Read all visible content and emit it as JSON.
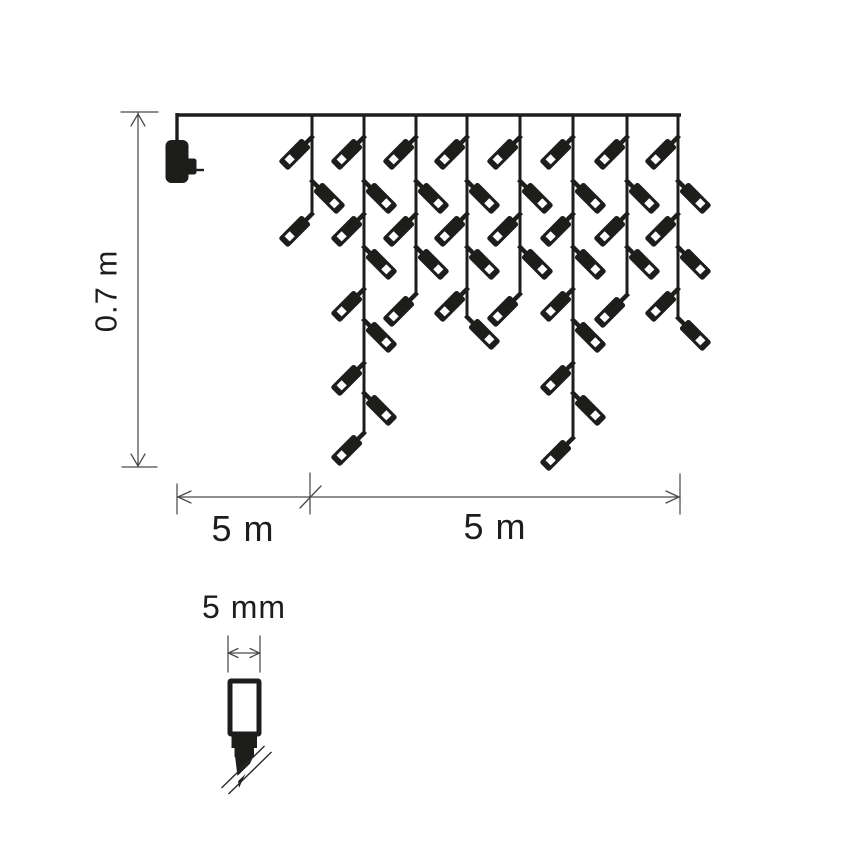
{
  "diagram": {
    "description": "Dimension diagram of icicle christmas light chain with power adapter and LED bulb detail",
    "colors": {
      "ink": "#1d1d1b",
      "dim_line": "#4a4a4a",
      "background": "#ffffff",
      "bulb_window": "#ffffff"
    },
    "labels": {
      "height": "0.7 m",
      "lead_length": "5 m",
      "lit_length": "5 m",
      "bulb_width": "5 mm"
    },
    "label_positions": {
      "height": {
        "x": 106,
        "y": 291
      },
      "lead_length": {
        "x": 243,
        "y": 529
      },
      "lit_length": {
        "x": 495,
        "y": 527
      },
      "bulb_width": {
        "x": 244,
        "y": 607
      }
    },
    "main_wire": {
      "x1": 177,
      "x2": 681,
      "y": 115,
      "thickness": 3.4
    },
    "adapter": {
      "drop": {
        "x": 177,
        "y1": 113,
        "y2": 143
      },
      "body": {
        "x": 165.5,
        "y": 140,
        "w": 23,
        "h": 43,
        "rx": 6
      },
      "tab": {
        "x": 186,
        "y": 158.5,
        "w": 10.5,
        "h": 16,
        "rx": 2.5
      },
      "prong": {
        "x1": 196,
        "y1": 170,
        "x2": 204,
        "y2": 170
      }
    },
    "strands": [
      {
        "x": 312,
        "end": 214,
        "bulbs": [
          {
            "y": 137,
            "dir": "left"
          },
          {
            "y": 181,
            "dir": "right"
          },
          {
            "y": 214,
            "dir": "left"
          }
        ]
      },
      {
        "x": 364,
        "end": 433,
        "bulbs": [
          {
            "y": 137,
            "dir": "left"
          },
          {
            "y": 181,
            "dir": "right"
          },
          {
            "y": 214,
            "dir": "left"
          },
          {
            "y": 247,
            "dir": "right"
          },
          {
            "y": 289,
            "dir": "left"
          },
          {
            "y": 320,
            "dir": "right"
          },
          {
            "y": 363,
            "dir": "left"
          },
          {
            "y": 393,
            "dir": "right"
          },
          {
            "y": 433,
            "dir": "left"
          }
        ]
      },
      {
        "x": 416,
        "end": 294,
        "bulbs": [
          {
            "y": 137,
            "dir": "left"
          },
          {
            "y": 181,
            "dir": "right"
          },
          {
            "y": 214,
            "dir": "left"
          },
          {
            "y": 247,
            "dir": "right"
          },
          {
            "y": 294,
            "dir": "left"
          }
        ]
      },
      {
        "x": 467,
        "end": 317,
        "bulbs": [
          {
            "y": 137,
            "dir": "left"
          },
          {
            "y": 181,
            "dir": "right"
          },
          {
            "y": 214,
            "dir": "left"
          },
          {
            "y": 247,
            "dir": "right"
          },
          {
            "y": 289,
            "dir": "left"
          },
          {
            "y": 317,
            "dir": "right"
          }
        ]
      },
      {
        "x": 520,
        "end": 294,
        "bulbs": [
          {
            "y": 137,
            "dir": "left"
          },
          {
            "y": 181,
            "dir": "right"
          },
          {
            "y": 214,
            "dir": "left"
          },
          {
            "y": 247,
            "dir": "right"
          },
          {
            "y": 294,
            "dir": "left"
          }
        ]
      },
      {
        "x": 573,
        "end": 438,
        "bulbs": [
          {
            "y": 137,
            "dir": "left"
          },
          {
            "y": 181,
            "dir": "right"
          },
          {
            "y": 214,
            "dir": "left"
          },
          {
            "y": 247,
            "dir": "right"
          },
          {
            "y": 289,
            "dir": "left"
          },
          {
            "y": 320,
            "dir": "right"
          },
          {
            "y": 363,
            "dir": "left"
          },
          {
            "y": 393,
            "dir": "right"
          },
          {
            "y": 438,
            "dir": "left"
          }
        ]
      },
      {
        "x": 627,
        "end": 295,
        "bulbs": [
          {
            "y": 137,
            "dir": "left"
          },
          {
            "y": 181,
            "dir": "right"
          },
          {
            "y": 214,
            "dir": "left"
          },
          {
            "y": 247,
            "dir": "right"
          },
          {
            "y": 295,
            "dir": "left"
          }
        ]
      },
      {
        "x": 678,
        "end": 318,
        "bulbs": [
          {
            "y": 137,
            "dir": "left"
          },
          {
            "y": 181,
            "dir": "right"
          },
          {
            "y": 214,
            "dir": "left"
          },
          {
            "y": 247,
            "dir": "right"
          },
          {
            "y": 289,
            "dir": "left"
          },
          {
            "y": 318,
            "dir": "right"
          }
        ]
      }
    ],
    "bulb_shape": {
      "neck": {
        "x": -2.2,
        "y": -2,
        "w": 4.4,
        "h": 11
      },
      "body": {
        "x": -6.7,
        "y": 8,
        "w": 13.4,
        "h": 33,
        "rx": 2.5
      },
      "window": {
        "x": -3.6,
        "y": 28,
        "w": 7.2,
        "h": 7.2
      }
    },
    "height_dimension": {
      "x": 138,
      "y1": 113,
      "y2": 467,
      "top_tick": {
        "x1": 121,
        "x2": 158
      },
      "bottom_tick": {
        "x1": 122,
        "x2": 157
      }
    },
    "length_dimension": {
      "y": 497,
      "x1": 177,
      "x_mid": 310,
      "x2": 680,
      "ext_left": {
        "y1": 484,
        "y2": 514
      },
      "ext_mid": {
        "y1": 473,
        "y2": 514
      },
      "ext_right": {
        "y1": 474,
        "y2": 514
      },
      "slash": {
        "x1": 300,
        "y1": 508,
        "x2": 321,
        "y2": 486
      }
    },
    "detail": {
      "dimension": {
        "x1": 228,
        "x2": 260,
        "y": 653,
        "ext_y1": 636,
        "ext_y2": 672
      },
      "lens": {
        "x": 230,
        "y": 681,
        "w": 29,
        "h": 53,
        "border": 5
      },
      "base_upper": {
        "x": 231.5,
        "y": 736,
        "w": 25.5,
        "h": 12
      },
      "base_lower": {
        "x": 234.5,
        "y": 747,
        "w": 19.5,
        "h": 10
      },
      "nib_points": "235,756 253.5,756 239,788",
      "break_gap": {
        "x1": 225,
        "y1": 791,
        "x2": 268,
        "y2": 749,
        "w": 4.2
      },
      "break_lines": [
        {
          "x1": 221.5,
          "y1": 788,
          "x2": 264.5,
          "y2": 746
        },
        {
          "x1": 228.5,
          "y1": 794,
          "x2": 271.5,
          "y2": 752
        }
      ]
    }
  }
}
